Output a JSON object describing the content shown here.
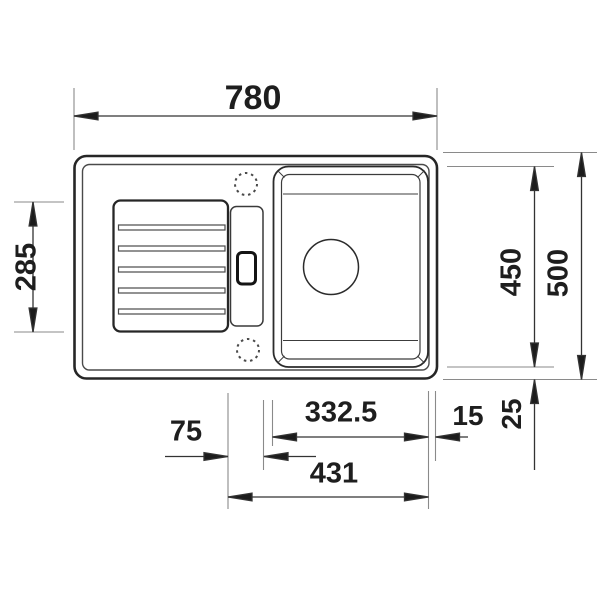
{
  "drawing": {
    "background": "#ffffff",
    "outline_color": "#262626",
    "dimension_line_color": "#333333",
    "extension_line_color": "#8a8a8a",
    "text_color": "#1e1e1e"
  },
  "dimensions": {
    "overall_width": "780",
    "overall_depth": "500",
    "bowl_outer_depth": "450",
    "drainboard_length": "285",
    "bowl_width": "332.5",
    "bowl_to_edge_gap": "15",
    "rim_border": "25",
    "control_panel_width": "75",
    "bowl_assembly_width": "431"
  }
}
